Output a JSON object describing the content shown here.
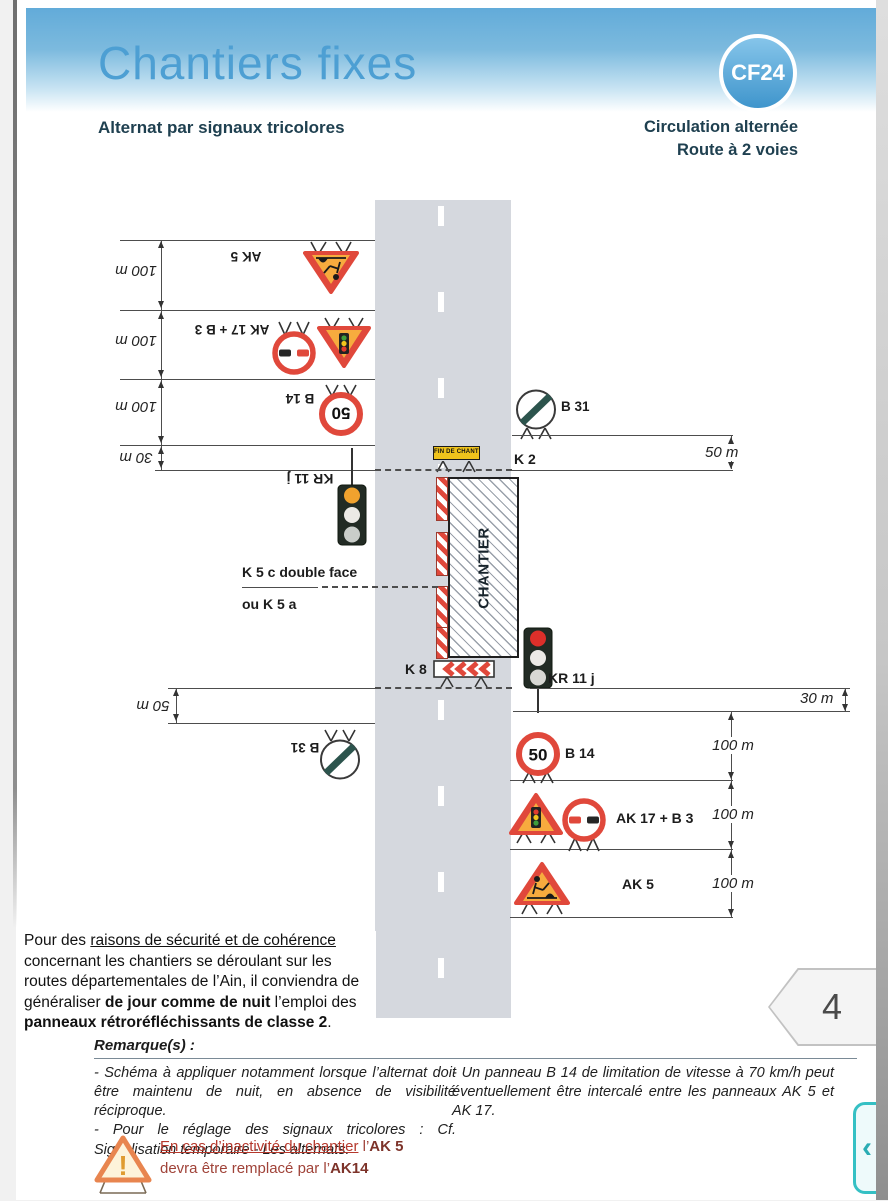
{
  "colors": {
    "header_blue": "#4d9fd3",
    "badge_blue": "#3f95cc",
    "dark_teal": "#1f4050",
    "sign_red": "#e0483b",
    "sign_orange": "#f7ab3e",
    "warning_text_red": "#b5382c",
    "nav_teal": "#35c0c4",
    "road_gray": "#d5d8de"
  },
  "header": {
    "title": "Chantiers fixes",
    "badge": "CF24",
    "subtitle": "Alternat par signaux tricolores",
    "context_line1": "Circulation alternée",
    "context_line2": "Route à 2 voies"
  },
  "diagram": {
    "work_zone": "CHANTIER",
    "banner": "FIN DE CHANTIER",
    "speed_value": "50",
    "labels": {
      "ak5": "AK 5",
      "ak17b3": "AK 17 + B 3",
      "b14": "B 14",
      "b31": "B 31",
      "k2": "K 2",
      "k8": "K 8",
      "kr11j": "KR 11 j",
      "k5c_line1": "K 5 c double face",
      "k5c_line2": "ou K 5 a"
    },
    "distances": {
      "d100": "100 m",
      "d50": "50 m",
      "d30": "30 m"
    }
  },
  "note": {
    "s1": "Pour des ",
    "s2": "raisons de sécurité et de cohérence",
    "s3": " concernant les chantiers se déroulant sur les routes départementales de l’Ain, il conviendra de généraliser ",
    "s4": "de jour comme de nuit",
    "s5": " l’emploi des ",
    "s6": "panneaux rétroréfléchissants de classe 2",
    "s7": "."
  },
  "remarks": {
    "heading": "Remarque(s) :",
    "left_item1": "- Schéma à appliquer notamment lorsque l’alternat doit être maintenu de nuit, en absence de visibilité réciproque.",
    "left_item2": "- Pour le réglage des signaux tricolores : Cf. Signalisation temporaire - Les alternats.",
    "right_item1": "- Un panneau B 14 de limitation de vitesse à 70 km/h peut éventuellement être intercalé entre les panneaux AK 5 et AK 17."
  },
  "warning": {
    "w1": "En cas d’inactivité du chantier",
    "w2": " l’",
    "w3": "AK 5",
    "w4": "devra être remplacé par l’",
    "w5": "AK14"
  },
  "pager": {
    "page_number": "4",
    "nav_chevron": "‹"
  }
}
